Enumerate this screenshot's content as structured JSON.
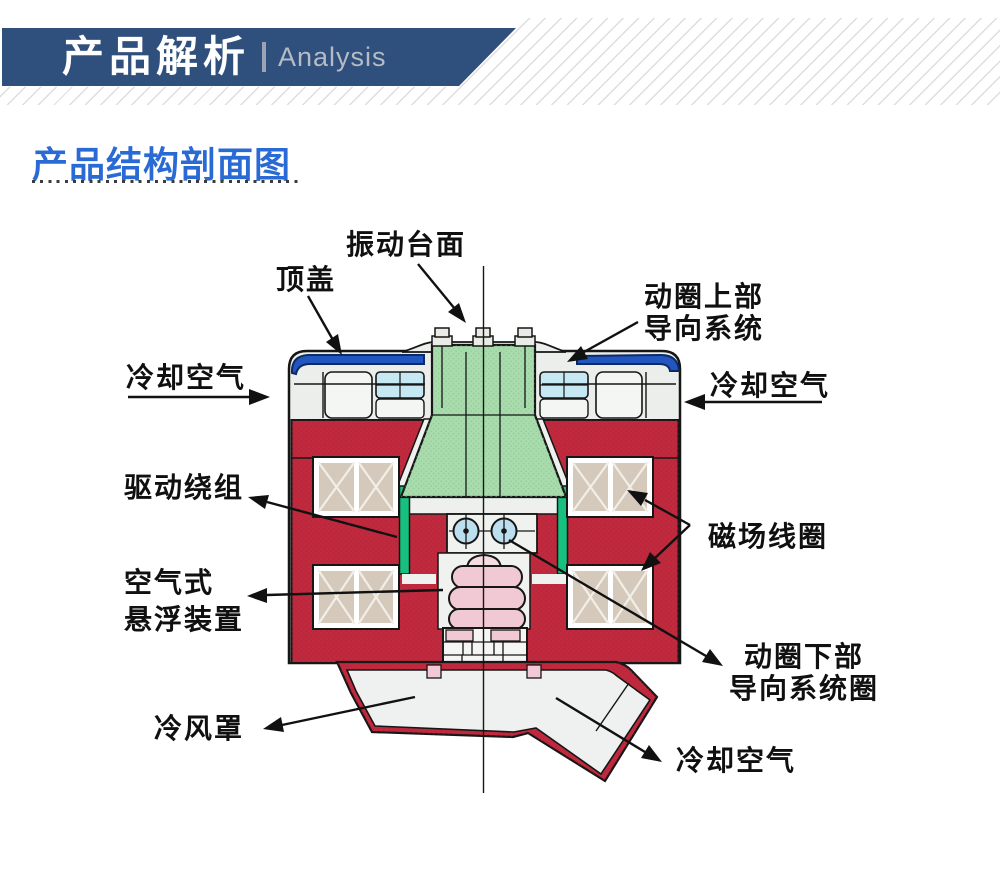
{
  "header": {
    "title": "产品解析",
    "subtitle_en": "Analysis",
    "banner_color": "#2f4f7d",
    "hatch_color": "#e2e2e2"
  },
  "section": {
    "title": "产品结构剖面图",
    "title_color": "#2a6ad4"
  },
  "diagram": {
    "type": "labeled-cross-section",
    "subject": "electrodynamic vibration shaker cross-section",
    "labels": [
      {
        "id": "vibration-table",
        "text": "振动台面"
      },
      {
        "id": "top-cover",
        "text": "顶盖"
      },
      {
        "id": "cooling-air-left",
        "text": "冷却空气"
      },
      {
        "id": "coil-upper-guide",
        "text": "动圈上部\n导向系统"
      },
      {
        "id": "cooling-air-right",
        "text": "冷却空气"
      },
      {
        "id": "drive-winding",
        "text": "驱动绕组"
      },
      {
        "id": "field-coil",
        "text": "磁场线圈"
      },
      {
        "id": "air-suspension",
        "text": "空气式\n悬浮装置"
      },
      {
        "id": "coil-lower-guide",
        "text": "动圈下部\n导向系统圈"
      },
      {
        "id": "cold-air-hood",
        "text": "冷风罩"
      },
      {
        "id": "cooling-air-bottom",
        "text": "冷却空气"
      }
    ],
    "colors": {
      "body_red": "#c12a3e",
      "armature_green": "#a9dcac",
      "guide_strip_green": "#17c07e",
      "cap_blue": "#2156c0",
      "coil_tan": "#d4c9bb",
      "bearing_blue": "#bcdff0",
      "bellows_pink": "#f1c9d5",
      "panel_gray": "#ebeeea"
    }
  }
}
